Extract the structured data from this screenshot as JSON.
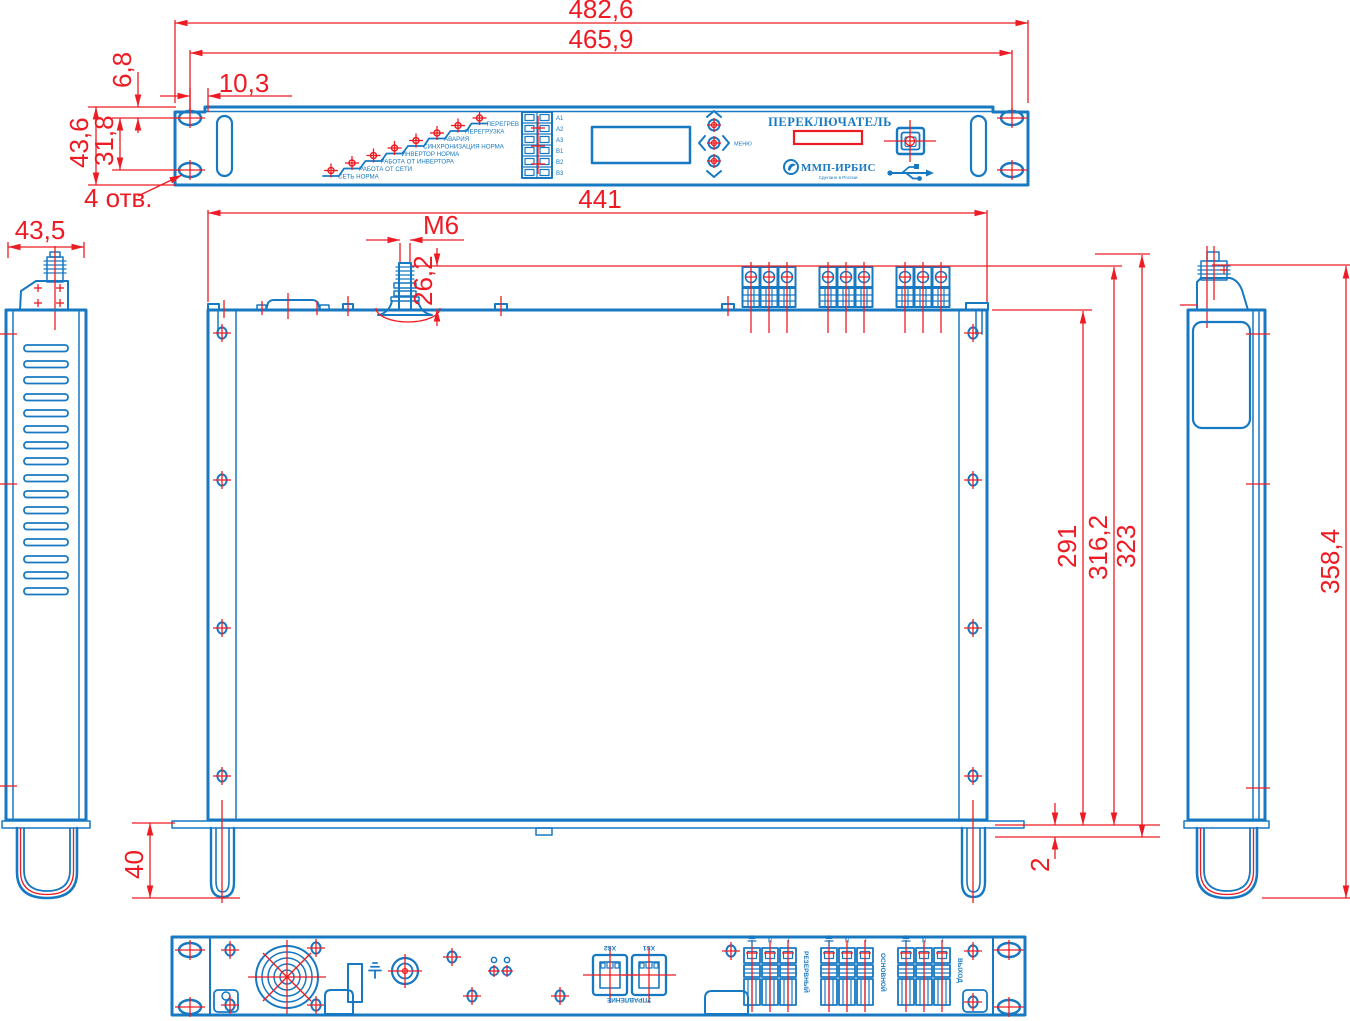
{
  "dims": {
    "width_overall": "482,6",
    "width_holes": "465,9",
    "hole_to_edge": "10,3",
    "hole_to_top": "6,8",
    "front_height": "43,6",
    "holes_vertical": "31,8",
    "holes_count": "4 отв.",
    "side_width": "43,5",
    "chassis_width": "441",
    "stud_thread": "M6",
    "stud_height": "26,2",
    "depth_body": "291",
    "depth_mid": "316,2",
    "depth_overall": "323",
    "side_height": "358,4",
    "handle_depth": "40",
    "plate_thickness": "2"
  },
  "front": {
    "leds": [
      "СЕТЬ НОРМА",
      "РАБОТА ОТ СЕТИ",
      "РАБОТА ОТ ИНВЕРТОРА",
      "ИНВЕРТОР НОРМА",
      "СИНХРОНИЗАЦИЯ НОРМА",
      "АВАРИЯ",
      "ПЕРЕГРУЗКА",
      "ПЕРЕГРЕВ"
    ],
    "signal_terminals": [
      "A1",
      "A2",
      "A3",
      "B1",
      "B2",
      "B3"
    ],
    "menu_label": "МЕНЮ",
    "switch_label": "ПЕРЕКЛЮЧАТЕЛЬ",
    "brand": "ММП-ИРБИС",
    "brand_sub": "Сделано в России"
  },
  "rear": {
    "connectors": [
      "XS2",
      "XS1"
    ],
    "control_label": "УПРАВЛЕНИЕ",
    "blocks": [
      "РЕЗЕРВНЫЙ",
      "ОСНОВНОЙ",
      "ВЫХОД"
    ],
    "pins": [
      "⏚",
      "N",
      "L"
    ]
  },
  "colors": {
    "line": "#1779c2",
    "dimension": "#ed1c24",
    "background": "#ffffff"
  }
}
